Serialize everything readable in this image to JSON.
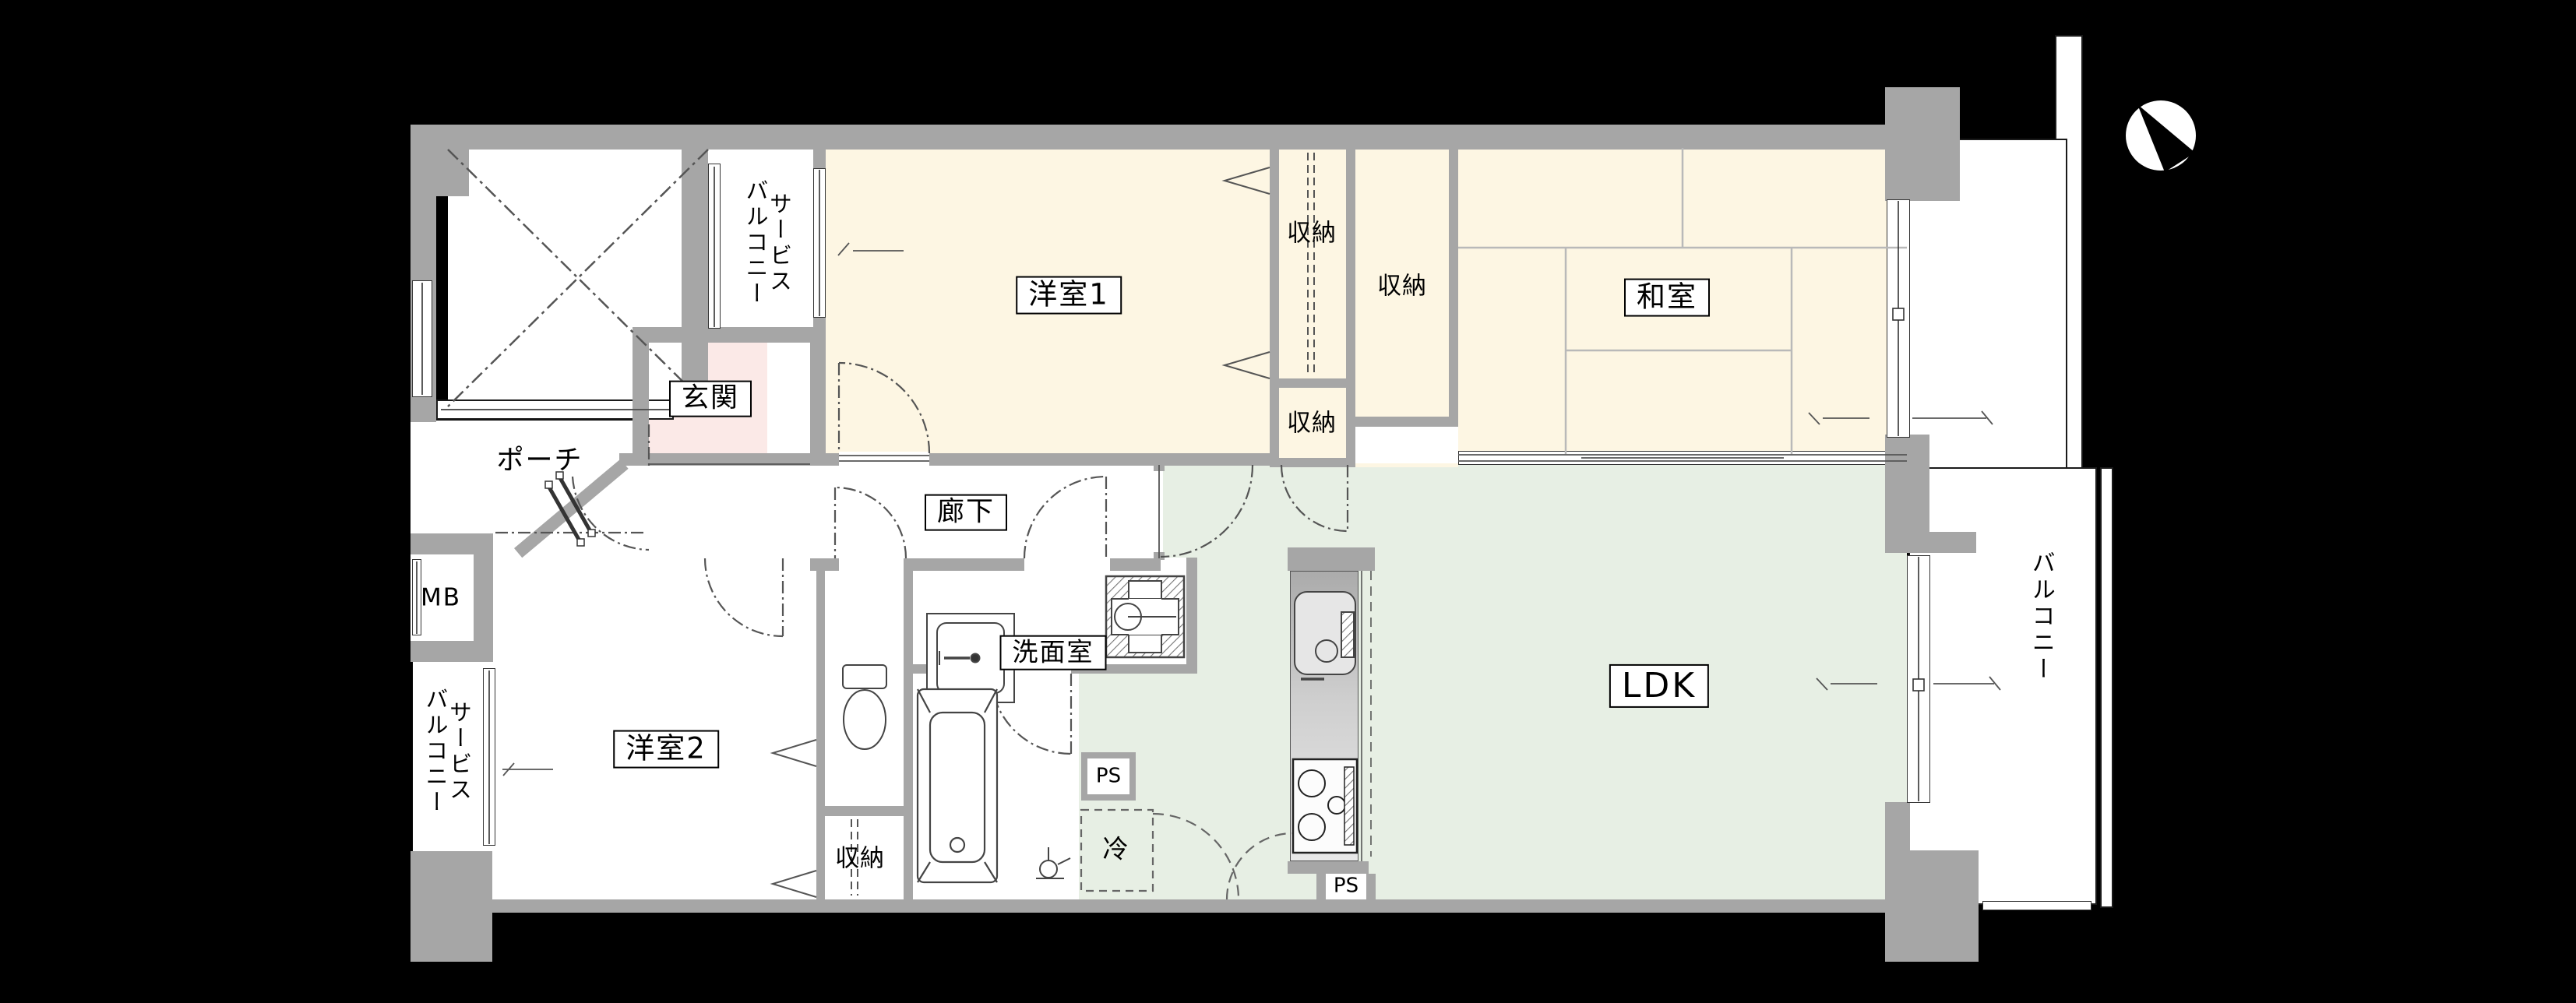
{
  "plan": {
    "title": "マンション間取り図",
    "type": "floor-plan"
  },
  "colors": {
    "wall": "#a6a6a6",
    "room_cream": "#fdf6e3",
    "ldk_green": "#e7efe4",
    "genkan_pink": "#fbe9e7",
    "outside": "#000000"
  },
  "rooms": {
    "western1": {
      "label": "洋室1"
    },
    "western2": {
      "label": "洋室2"
    },
    "japanese": {
      "label": "和室"
    },
    "ldk": {
      "label": "LDK"
    },
    "genkan": {
      "label": "玄関"
    },
    "corridor": {
      "label": "廊下"
    },
    "washroom": {
      "label": "洗面室"
    },
    "porch": {
      "label": "ポーチ"
    },
    "balcony": {
      "label": "バルコニー"
    },
    "service_balcony_north": {
      "label": "サービス\nバルコニー"
    },
    "service_balcony_west": {
      "label": "サービス\nバルコニー"
    },
    "meter_box": {
      "label": "MB"
    },
    "refrigerator_space": {
      "label": "冷"
    },
    "pipe_space_upper": {
      "label": "PS"
    },
    "pipe_space_lower": {
      "label": "PS"
    },
    "storage_west1_top": {
      "label": "収納"
    },
    "storage_west1_small": {
      "label": "収納"
    },
    "storage_japanese": {
      "label": "収納"
    },
    "storage_west2": {
      "label": "収納"
    }
  }
}
